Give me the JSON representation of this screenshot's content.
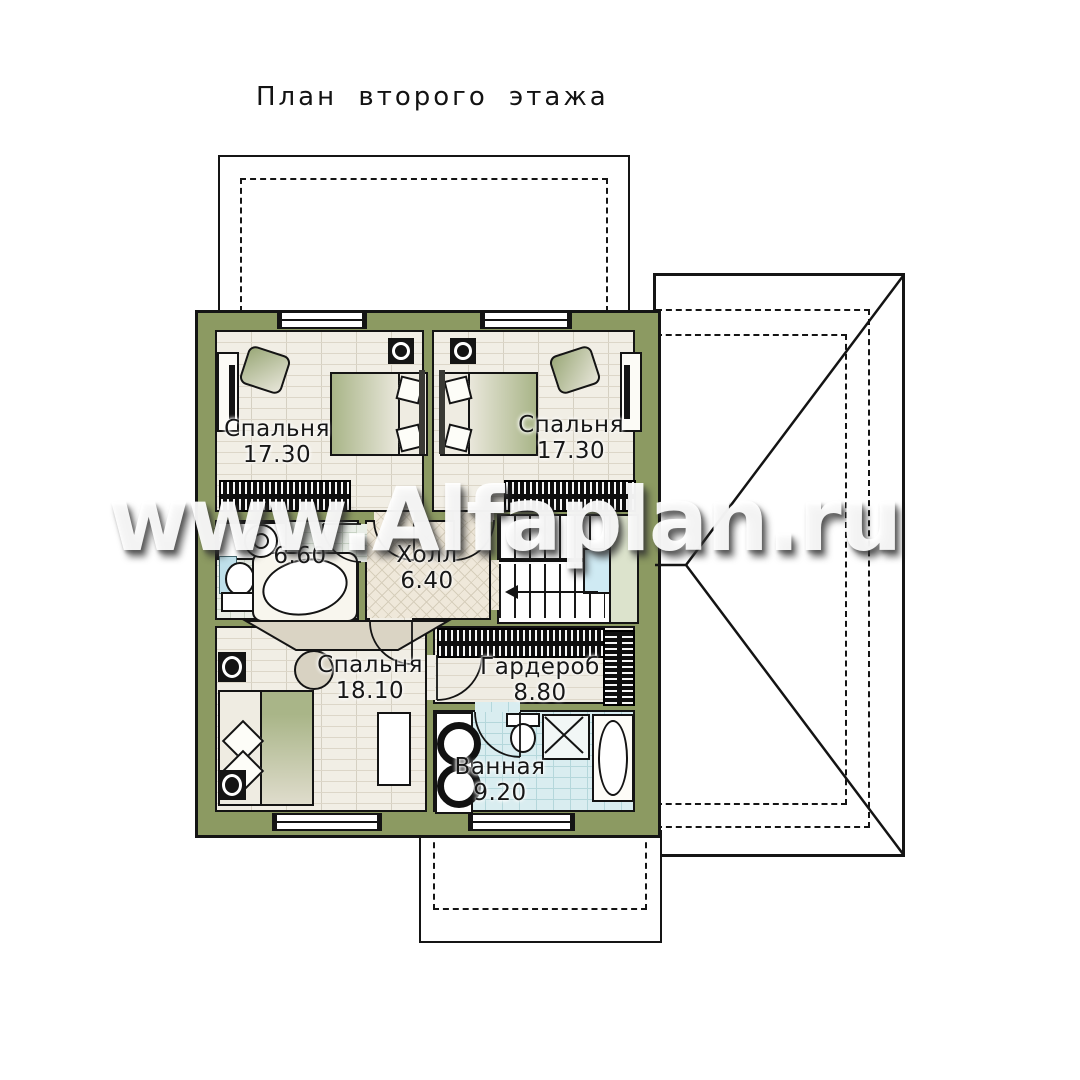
{
  "title": "План второго этажа",
  "watermark": "www.Alfaplan.ru",
  "rooms": {
    "bedroom_left": {
      "name": "Спальня",
      "area": "17.30"
    },
    "bedroom_right": {
      "name": "Спальня",
      "area": "17.30"
    },
    "bath_small": {
      "area": "6.60"
    },
    "hall": {
      "name": "Холл",
      "area": "6.40"
    },
    "bedroom_master": {
      "name": "Спальня",
      "area": "18.10"
    },
    "wardrobe": {
      "name": "Гардероб",
      "area": "8.80"
    },
    "bathroom": {
      "name": "Ванная",
      "area": "9.20"
    }
  },
  "annotations": {
    "washing_machine": "стм"
  },
  "colors": {
    "wall_olive": "#8c9a62",
    "floor_parquet": "#f1eee5",
    "floor_diamond": "#efe8da",
    "tile_blue": "#d9edf0",
    "tile_pale": "#e9eee7",
    "landing_green": "#dce3cc",
    "accent_blue": "#cfeaf3"
  }
}
